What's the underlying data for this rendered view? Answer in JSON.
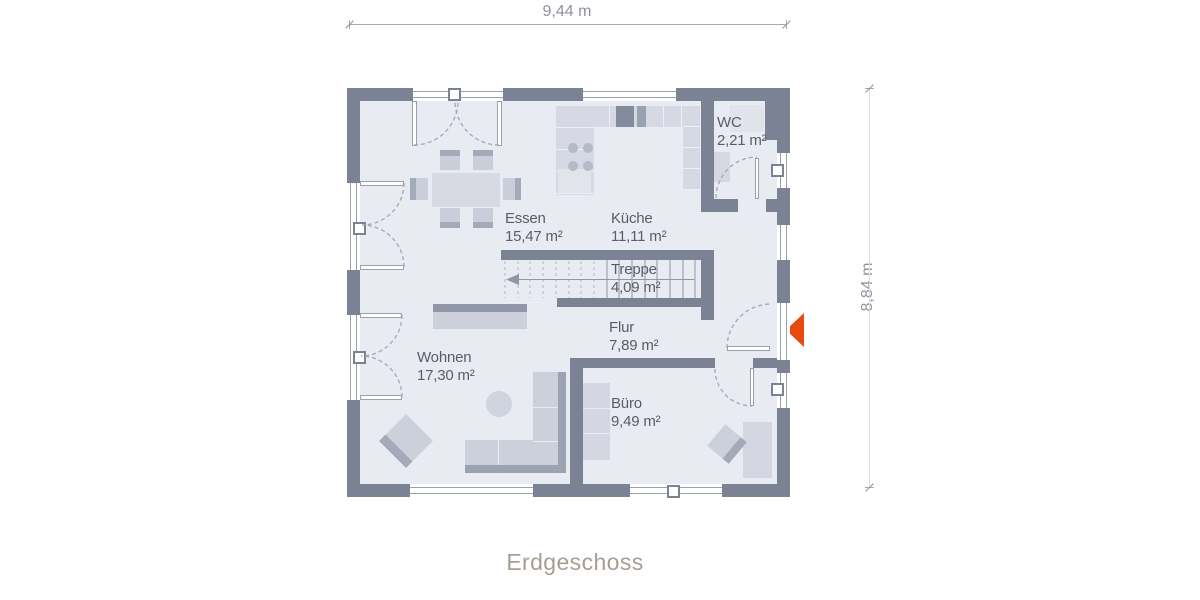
{
  "title": "Erdgeschoss",
  "dimensions": {
    "width": "9,44 m",
    "height": "8,84 m"
  },
  "rooms": [
    {
      "name": "Essen",
      "area": "15,47 m²"
    },
    {
      "name": "Küche",
      "area": "11,11 m²"
    },
    {
      "name": "WC",
      "area": "2,21 m²"
    },
    {
      "name": "Treppe",
      "area": "4,09 m²"
    },
    {
      "name": "Flur",
      "area": "7,89 m²"
    },
    {
      "name": "Wohnen",
      "area": "17,30 m²"
    },
    {
      "name": "Büro",
      "area": "9,49 m²"
    }
  ],
  "colors": {
    "wall": "#7a8293",
    "floor": "#e9ebf2",
    "entrance_accent": "#e8490f",
    "room_text": "#585d69",
    "title_text": "#a79e93",
    "dimension_text": "#8d929b"
  }
}
